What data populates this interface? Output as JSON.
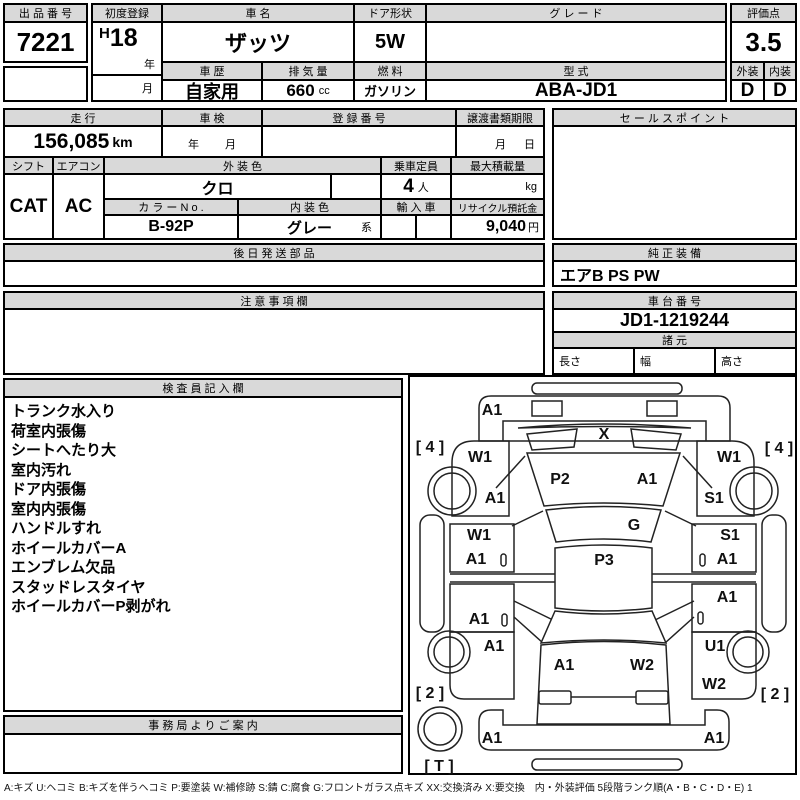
{
  "top": {
    "auction_no": {
      "label": "出 品 番 号",
      "value": "7221"
    },
    "first_reg": {
      "label": "初度登録",
      "era": "H",
      "year": "18",
      "year_unit": "年",
      "month_unit": "月"
    },
    "car_name": {
      "label": "車  名",
      "value": "ザッツ"
    },
    "door": {
      "label": "ドア形状",
      "value": "5W"
    },
    "grade": {
      "label": "グ  レ  ー  ド",
      "value": ""
    },
    "score": {
      "label": "評価点",
      "value": "3.5"
    },
    "history": {
      "label": "車 歴",
      "value": "自家用"
    },
    "displacement": {
      "label": "排 気 量",
      "value": "660",
      "unit": "cc"
    },
    "fuel": {
      "label": "燃 料",
      "value": "ガソリン"
    },
    "model": {
      "label": "型 式",
      "value": "ABA-JD1"
    },
    "exterior": {
      "label": "外装",
      "value": "D"
    },
    "interior": {
      "label": "内装",
      "value": "D"
    }
  },
  "mid": {
    "mileage": {
      "label": "走 行",
      "value": "156,085",
      "unit": "km"
    },
    "inspection": {
      "label": "車 検",
      "year_unit": "年",
      "month_unit": "月"
    },
    "reg_no": {
      "label": "登 録 番 号",
      "value": ""
    },
    "transfer": {
      "label": "譲渡書類期限",
      "month_unit": "月",
      "day_unit": "日"
    },
    "sales_point": {
      "label": "セ ー ル ス ポ イ ン ト",
      "value": ""
    },
    "shift": {
      "label": "シフト",
      "value": "CAT"
    },
    "aircon": {
      "label": "エアコン",
      "value": "AC"
    },
    "ext_color": {
      "label": "外 装 色",
      "value": "クロ"
    },
    "capacity": {
      "label": "乗車定員",
      "value": "4",
      "unit": "人"
    },
    "max_load": {
      "label": "最大積載量",
      "value": "",
      "unit": "kg"
    },
    "color_no": {
      "label": "カ ラ ー N o .",
      "value": "B-92P"
    },
    "int_color": {
      "label": "内 装 色",
      "value": "グレー",
      "suffix": "系"
    },
    "import_car": {
      "label": "輸 入 車",
      "value": ""
    },
    "recycle": {
      "label": "リサイクル預託金",
      "value": "9,040",
      "unit": "円"
    }
  },
  "parts_later": {
    "label": "後 日 発 送 部 品",
    "value": ""
  },
  "equipment": {
    "label": "純 正 装 備",
    "value": "エアB PS PW"
  },
  "caution": {
    "label": "注 意 事 項 欄",
    "value": ""
  },
  "chassis": {
    "label": "車 台 番 号",
    "value": "JD1-1219244"
  },
  "specs": {
    "label": "諸 元",
    "length_label": "長さ",
    "width_label": "幅",
    "height_label": "高さ"
  },
  "inspector": {
    "label": "検 査 員 記 入 欄",
    "items": [
      "トランク水入り",
      "荷室内張傷",
      "シートへたり大",
      "室内汚れ",
      "ドア内張傷",
      "室内内張傷",
      "ハンドルすれ",
      "ホイールカバーA",
      "エンブレム欠品",
      "スタッドレスタイヤ",
      "ホイールカバーP剥がれ"
    ]
  },
  "office": {
    "label": "事 務 局 よ り ご 案 内",
    "value": ""
  },
  "legend": "A:キズ U:ヘコミ B:キズを伴うヘコミ P:要塗装 W:補修跡 S:錆 C:腐食 G:フロントガラス点キズ XX:交換済み X:要交換　内・外装評価 5段階ランク順(A・B・C・D・E) 1",
  "diagram": {
    "marks": [
      {
        "text": "A1",
        "x": 82,
        "y": 34
      },
      {
        "text": "X",
        "x": 194,
        "y": 58
      },
      {
        "text": "[ 4 ]",
        "x": 20,
        "y": 71
      },
      {
        "text": "[ 4 ]",
        "x": 369,
        "y": 72
      },
      {
        "text": "W1",
        "x": 70,
        "y": 81
      },
      {
        "text": "W1",
        "x": 319,
        "y": 81
      },
      {
        "text": "P2",
        "x": 150,
        "y": 103
      },
      {
        "text": "A1",
        "x": 237,
        "y": 103
      },
      {
        "text": "A1",
        "x": 85,
        "y": 122
      },
      {
        "text": "S1",
        "x": 304,
        "y": 122
      },
      {
        "text": "G",
        "x": 224,
        "y": 149
      },
      {
        "text": "W1",
        "x": 69,
        "y": 159
      },
      {
        "text": "S1",
        "x": 320,
        "y": 159
      },
      {
        "text": "A1",
        "x": 66,
        "y": 183
      },
      {
        "text": "A1",
        "x": 317,
        "y": 183
      },
      {
        "text": "P3",
        "x": 194,
        "y": 184
      },
      {
        "text": "A1",
        "x": 317,
        "y": 221
      },
      {
        "text": "A1",
        "x": 69,
        "y": 243
      },
      {
        "text": "A1",
        "x": 84,
        "y": 270
      },
      {
        "text": "U1",
        "x": 305,
        "y": 270
      },
      {
        "text": "A1",
        "x": 154,
        "y": 289
      },
      {
        "text": "W2",
        "x": 232,
        "y": 289
      },
      {
        "text": "W2",
        "x": 304,
        "y": 308
      },
      {
        "text": "[ 2 ]",
        "x": 20,
        "y": 317
      },
      {
        "text": "[ 2 ]",
        "x": 365,
        "y": 318
      },
      {
        "text": "A1",
        "x": 82,
        "y": 362
      },
      {
        "text": "A1",
        "x": 304,
        "y": 362
      },
      {
        "text": "[ T ]",
        "x": 29,
        "y": 390
      }
    ]
  }
}
